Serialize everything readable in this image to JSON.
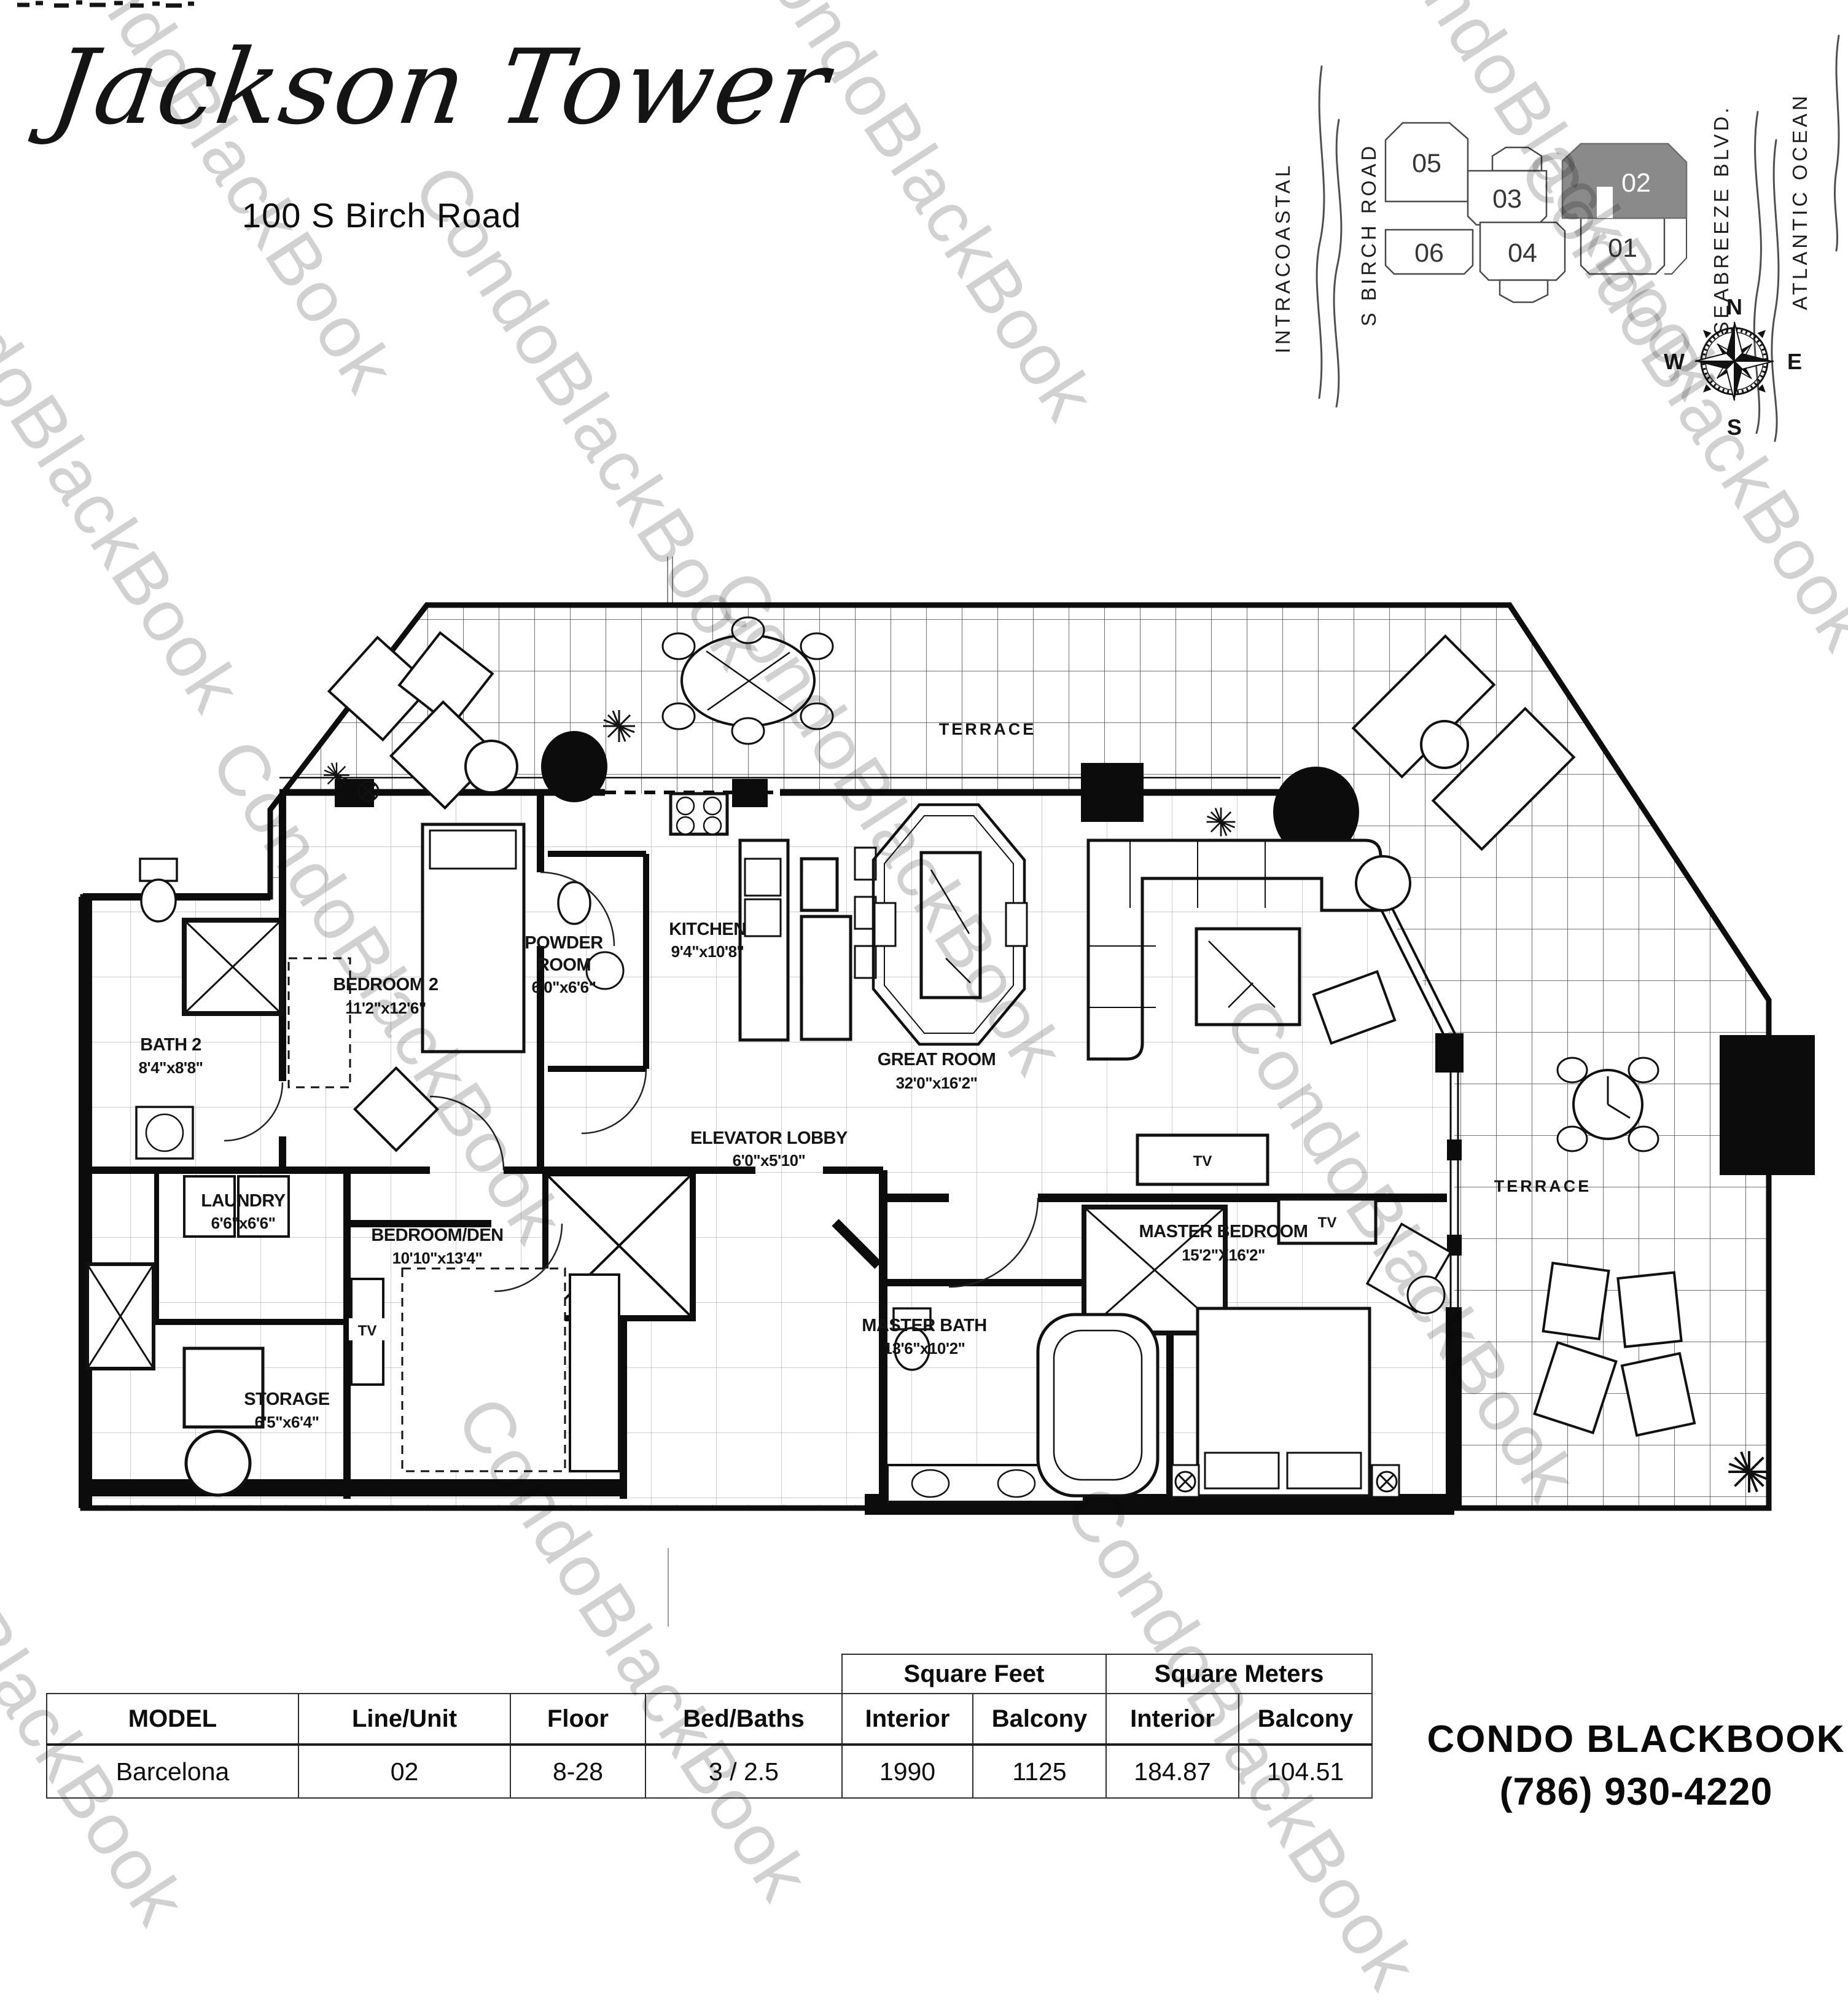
{
  "watermark": "CondoBlackBook",
  "header": {
    "title": "Jackson Tower",
    "address": "100 S Birch Road"
  },
  "site_map": {
    "streets": [
      "INTRACOASTAL",
      "S BIRCH ROAD",
      "SEABREEZE BLVD.",
      "ATLANTIC OCEAN"
    ],
    "units": [
      "05",
      "03",
      "02",
      "06",
      "04",
      "01"
    ],
    "highlighted_unit": "02",
    "highlight_color": "#8a8a8a",
    "compass": {
      "n": "N",
      "e": "E",
      "s": "S",
      "w": "W"
    }
  },
  "floor_plan": {
    "tv": "TV",
    "rooms": {
      "terrace_top": {
        "label": "TERRACE"
      },
      "terrace_right": {
        "label": "TERRACE"
      },
      "bedroom_2": {
        "label": "BEDROOM 2",
        "dims": "11'2\"x12'6\""
      },
      "bath_2": {
        "label": "BATH 2",
        "dims": "8'4\"x8'8\""
      },
      "powder_room": {
        "label_line1": "POWDER",
        "label_line2": "ROOM",
        "dims": "6'0\"x6'6\""
      },
      "kitchen": {
        "label": "KITCHEN",
        "dims": "9'4\"x10'8\""
      },
      "great_room": {
        "label": "GREAT ROOM",
        "dims": "32'0\"x16'2\""
      },
      "elevator_lobby": {
        "label": "ELEVATOR LOBBY",
        "dims": "6'0\"x5'10\""
      },
      "laundry": {
        "label": "LAUNDRY",
        "dims": "6'6\"x6'6\""
      },
      "bedroom_den": {
        "label": "BEDROOM/DEN",
        "dims": "10'10\"x13'4\""
      },
      "storage": {
        "label": "STORAGE",
        "dims": "6'5\"x6'4\""
      },
      "master_bedroom": {
        "label": "MASTER BEDROOM",
        "dims": "15'2\"X16'2\""
      },
      "master_bath": {
        "label": "MASTER BATH",
        "dims": "13'6\"x10'2\""
      }
    }
  },
  "spec_table": {
    "group_headers": {
      "square_feet": "Square Feet",
      "square_meters": "Square Meters"
    },
    "columns": {
      "model": "MODEL",
      "line_unit": "Line/Unit",
      "floor": "Floor",
      "bed_baths": "Bed/Baths",
      "sf_interior": "Interior",
      "sf_balcony": "Balcony",
      "sm_interior": "Interior",
      "sm_balcony": "Balcony"
    },
    "row": {
      "model": "Barcelona",
      "line_unit": "02",
      "floor": "8-28",
      "bed_baths": "3 / 2.5",
      "sf_interior": "1990",
      "sf_balcony": "1125",
      "sm_interior": "184.87",
      "sm_balcony": "104.51"
    }
  },
  "contact": {
    "brand": "CONDO BLACKBOOK",
    "phone": "(786) 930-4220"
  }
}
